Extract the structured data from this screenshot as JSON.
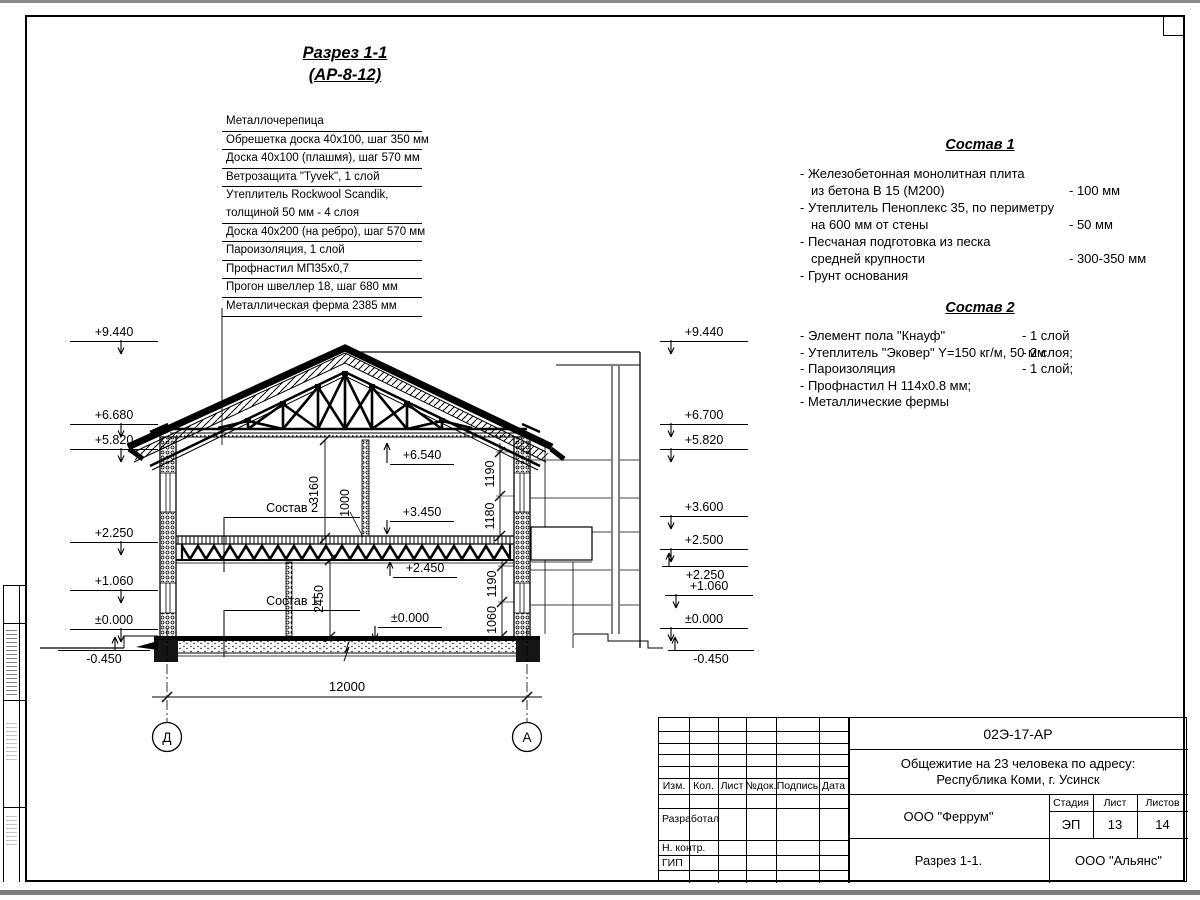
{
  "sheet": {
    "title_line1": "Разрез 1-1",
    "title_line2": "(АР-8-12)"
  },
  "roof_layers": [
    "Металлочерепица",
    "Обрешетка доска 40х100, шаг 350 мм",
    "Доска 40х100 (плашмя), шаг 570 мм",
    "Ветрозащита \"Tyvek\", 1 слой",
    "Утеплитель Rockwool Scandik,",
    "толщиной 50 мм - 4 слоя",
    "Доска 40х200 (на ребро), шаг 570 мм",
    "Пароизоляция, 1 слой",
    "Профнастил МП35х0,7",
    "Прогон швеллер 18, шаг 680 мм",
    "Металлическая ферма 2385 мм"
  ],
  "sostav1": {
    "title": "Состав 1",
    "rows": [
      {
        "t": "- Железобетонная  монолитная плита",
        "v": ""
      },
      {
        "t": "из бетона В 15 (М200)",
        "v": "- 100 мм"
      },
      {
        "t": "- Утеплитель Пеноплекс 35, по периметру",
        "v": ""
      },
      {
        "t": "на 600 мм от стены",
        "v": "- 50 мм"
      },
      {
        "t": "- Песчаная подготовка из песка",
        "v": ""
      },
      {
        "t": "средней крупности",
        "v": "- 300-350 мм"
      },
      {
        "t": "- Грунт основания",
        "v": ""
      }
    ]
  },
  "sostav2": {
    "title": "Состав 2",
    "rows": [
      {
        "t": "- Элемент пола \"Кнауф\"",
        "v": "- 1 слой"
      },
      {
        "t": "- Утеплитель \"Эковер\" Y=150 кг/м, 50 мм",
        "v": "- 2 слоя;"
      },
      {
        "t": "- Пароизоляция",
        "v": "- 1 слой;"
      },
      {
        "t": "- Профнастил Н 114х0.8 мм;",
        "v": ""
      },
      {
        "t": "- Металлические фермы",
        "v": ""
      }
    ]
  },
  "elevations": {
    "left": [
      "+9.440",
      "+6.680",
      "+5.820",
      "+2.250",
      "+1.060",
      "±0.000",
      "-0.450"
    ],
    "right": [
      "+9.440",
      "+6.700",
      "+5.820",
      "+3.600",
      "+2.500",
      "+2.250",
      "+1.060",
      "±0.000",
      "-0.450"
    ],
    "inner": [
      "+6.540",
      "+3.450",
      "+2.450",
      "±0.000"
    ]
  },
  "dims": {
    "span": "12000",
    "floor2_h": "3160",
    "note": "1000",
    "floor1_h": "2450",
    "win2_a": "1190",
    "win2_b": "1180",
    "win1_a": "1190",
    "win1_b": "1060"
  },
  "axes": {
    "left": "Д",
    "right": "А"
  },
  "refs": {
    "s1": "Состав 1",
    "s2": "Состав 2"
  },
  "titleblock": {
    "doc_code": "02Э-17-АР",
    "project_l1": "Общежитие на 23 человека по адресу:",
    "project_l2": "Республика Коми, г. Усинск",
    "cols": [
      "Изм.",
      "Кол.",
      "Лист",
      "№док.",
      "Подпись",
      "Дата"
    ],
    "row_developed": "Разработал",
    "row_ncontr": "Н. контр.",
    "row_gip": "ГИП",
    "org": "ООО \"Феррум\"",
    "stage_label": "Стадия",
    "sheet_label": "Лист",
    "sheets_label": "Листов",
    "stage": "ЭП",
    "sheet_num": "13",
    "sheets_total": "14",
    "drawing_title": "Разрез 1-1.",
    "org2": "ООО \"Альянс\""
  }
}
